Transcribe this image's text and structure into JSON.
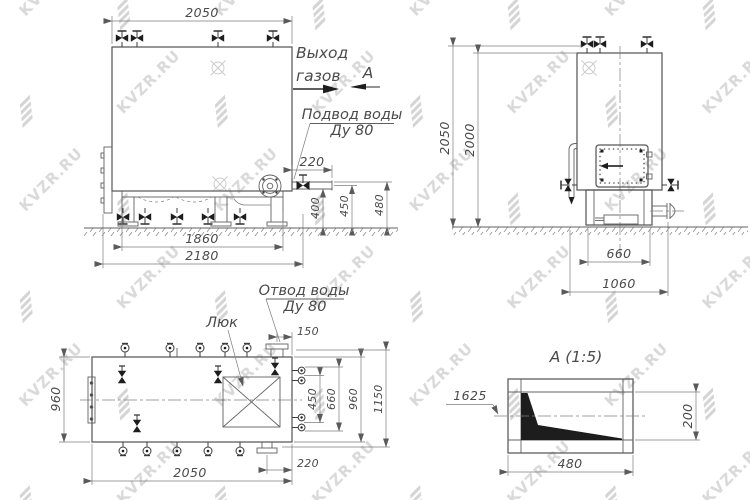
{
  "watermark": {
    "text": "KVZR.RU"
  },
  "views": {
    "front": {
      "labels": {
        "gas_out_1": "Выход",
        "gas_out_2": "газов",
        "section": "А",
        "water_in_1": "Подвод воды",
        "water_in_2": "Ду 80"
      },
      "dims": {
        "top_width": "2050",
        "pipe_offset": "220",
        "h1": "400",
        "h2": "450",
        "h3": "480",
        "support_span": "1860",
        "overall": "2180"
      }
    },
    "side": {
      "dims": {
        "h_total": "2050",
        "h_body": "2000",
        "support": "660",
        "base": "1060"
      }
    },
    "top": {
      "labels": {
        "hatch": "Люк",
        "water_out_1": "Отвод воды",
        "water_out_2": "Ду 80"
      },
      "dims": {
        "depth": "960",
        "outlet_offset": "150",
        "stub_span": "450",
        "stub_outer": "660",
        "width": "960",
        "overall": "1150",
        "length": "2050",
        "flange_offset": "220"
      }
    },
    "detail": {
      "title": "А  (1:5)",
      "dims": {
        "elevation": "1625",
        "height": "200",
        "width": "480"
      }
    }
  }
}
